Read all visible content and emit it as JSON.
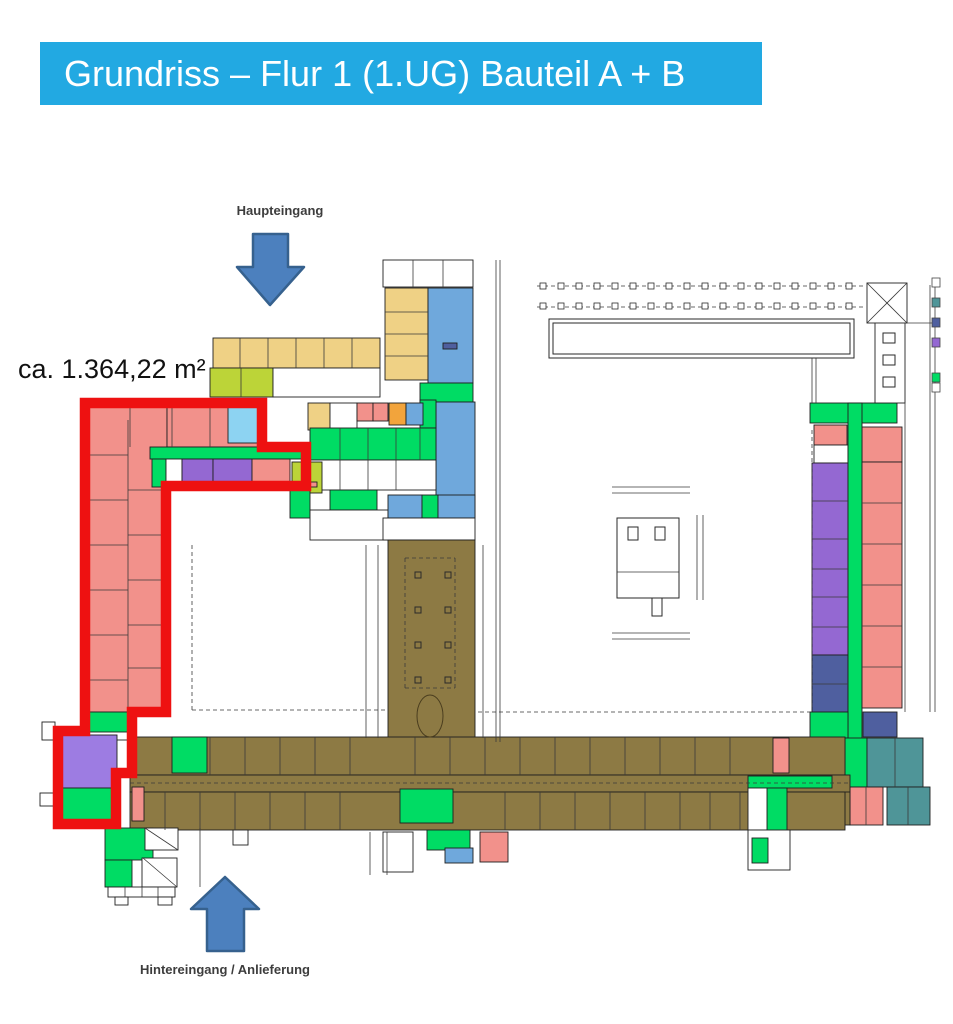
{
  "title": {
    "text": "Grundriss – Flur 1 (1.UG) Bauteil A + B"
  },
  "annotations": {
    "main_entrance": "Haupteingang",
    "area": "ca. 1.364,22 m²",
    "rear_entrance": "Hintereingang / Anlieferung"
  },
  "palette": {
    "header_bg": "#22A9E2",
    "red_outline": "#EE1111",
    "arrow_fill": "#4C80BE",
    "arrow_stroke": "#36618E",
    "sa": "#F2918B",
    "gr": "#00DC64",
    "bl": "#6FA8DC",
    "lb": "#8DD3F2",
    "wh": "#EFD185",
    "ch": "#BCD438",
    "or": "#F2A43C",
    "pu": "#9468D2",
    "pl": "#9D7CE2",
    "sl": "#4F5F9F",
    "te": "#4F9598",
    "br": "#8D7A44",
    "wt": "#FFFFFF"
  },
  "plan": {
    "outline_path": "M 85 403 L 262 403 L 262 447 L 306 447 L 306 486 L 166 486 L 166 712 L 132 712 L 132 773 L 116 773 L 116 824 L 58 824 L 58 731 L 85 731 Z",
    "rooms": [
      [
        383,
        260,
        90,
        27,
        "wt"
      ],
      [
        385,
        288,
        43,
        92,
        "wh"
      ],
      [
        428,
        288,
        45,
        95,
        "bl"
      ],
      [
        420,
        383,
        53,
        19,
        "gr"
      ],
      [
        436,
        402,
        39,
        116,
        "bl"
      ],
      [
        420,
        400,
        16,
        28,
        "gr"
      ],
      [
        213,
        338,
        167,
        30,
        "wh"
      ],
      [
        210,
        368,
        63,
        29,
        "ch"
      ],
      [
        273,
        368,
        107,
        29,
        "wt"
      ],
      [
        308,
        403,
        22,
        27,
        "wh"
      ],
      [
        330,
        403,
        27,
        27,
        "wt"
      ],
      [
        357,
        403,
        16,
        18,
        "sa"
      ],
      [
        373,
        403,
        15,
        18,
        "sa"
      ],
      [
        389,
        403,
        17,
        22,
        "or"
      ],
      [
        406,
        403,
        17,
        22,
        "bl"
      ],
      [
        310,
        428,
        126,
        32,
        "gr"
      ],
      [
        310,
        460,
        126,
        30,
        "wt"
      ],
      [
        292,
        462,
        30,
        31,
        "ch"
      ],
      [
        290,
        490,
        20,
        28,
        "gr"
      ],
      [
        330,
        490,
        47,
        20,
        "gr"
      ],
      [
        310,
        510,
        78,
        30,
        "wt"
      ],
      [
        388,
        495,
        34,
        23,
        "bl"
      ],
      [
        422,
        495,
        16,
        23,
        "gr"
      ],
      [
        438,
        495,
        37,
        23,
        "bl"
      ],
      [
        383,
        518,
        92,
        22,
        "wt"
      ],
      [
        85,
        400,
        82,
        312,
        "sa"
      ],
      [
        167,
        400,
        98,
        47,
        "sa"
      ],
      [
        228,
        405,
        37,
        38,
        "lb"
      ],
      [
        150,
        447,
        156,
        12,
        "gr"
      ],
      [
        152,
        459,
        14,
        28,
        "gr"
      ],
      [
        166,
        459,
        16,
        28,
        "wt"
      ],
      [
        182,
        459,
        31,
        28,
        "pu"
      ],
      [
        213,
        459,
        39,
        28,
        "pu"
      ],
      [
        252,
        459,
        38,
        28,
        "sa"
      ],
      [
        88,
        712,
        43,
        20,
        "gr"
      ],
      [
        116,
        740,
        16,
        33,
        "wt"
      ],
      [
        62,
        735,
        55,
        53,
        "pl"
      ],
      [
        62,
        788,
        55,
        36,
        "gr"
      ],
      [
        42,
        722,
        13,
        18,
        "wt"
      ],
      [
        40,
        793,
        16,
        13,
        "wt"
      ],
      [
        388,
        540,
        87,
        202,
        "br"
      ],
      [
        810,
        403,
        87,
        20,
        "gr"
      ],
      [
        814,
        425,
        33,
        20,
        "sa"
      ],
      [
        814,
        445,
        34,
        18,
        "wt"
      ],
      [
        862,
        427,
        40,
        35,
        "sa"
      ],
      [
        812,
        463,
        36,
        192,
        "pu"
      ],
      [
        812,
        655,
        36,
        57,
        "sl"
      ],
      [
        848,
        403,
        14,
        377,
        "gr"
      ],
      [
        862,
        462,
        40,
        246,
        "sa"
      ],
      [
        863,
        712,
        34,
        25,
        "sl"
      ],
      [
        810,
        712,
        38,
        26,
        "gr"
      ],
      [
        845,
        738,
        22,
        49,
        "gr"
      ],
      [
        867,
        738,
        56,
        49,
        "te"
      ],
      [
        887,
        787,
        43,
        38,
        "te"
      ],
      [
        850,
        787,
        33,
        38,
        "sa"
      ],
      [
        820,
        787,
        30,
        38,
        "br"
      ],
      [
        130,
        737,
        715,
        38,
        "br"
      ],
      [
        130,
        775,
        720,
        17,
        "br"
      ],
      [
        130,
        792,
        715,
        38,
        "br"
      ],
      [
        172,
        737,
        35,
        36,
        "gr"
      ],
      [
        773,
        738,
        16,
        35,
        "sa"
      ],
      [
        748,
        776,
        84,
        12,
        "gr"
      ],
      [
        767,
        788,
        20,
        79,
        "gr"
      ],
      [
        400,
        789,
        53,
        34,
        "gr"
      ],
      [
        132,
        787,
        12,
        34,
        "sa"
      ],
      [
        748,
        788,
        19,
        42,
        "wt"
      ],
      [
        427,
        830,
        43,
        20,
        "gr"
      ],
      [
        445,
        848,
        28,
        15,
        "bl"
      ],
      [
        480,
        832,
        28,
        30,
        "sa"
      ],
      [
        383,
        832,
        30,
        40,
        "wt"
      ],
      [
        748,
        830,
        42,
        40,
        "wt"
      ],
      [
        752,
        838,
        16,
        25,
        "gr"
      ],
      [
        105,
        828,
        48,
        32,
        "gr"
      ],
      [
        105,
        860,
        27,
        27,
        "gr"
      ],
      [
        145,
        828,
        33,
        22,
        "wt"
      ],
      [
        142,
        858,
        35,
        29,
        "wt"
      ],
      [
        108,
        887,
        67,
        10,
        "wt"
      ],
      [
        115,
        897,
        13,
        8,
        "wt"
      ],
      [
        158,
        897,
        14,
        8,
        "wt"
      ],
      [
        233,
        830,
        15,
        15,
        "wt"
      ],
      [
        867,
        283,
        40,
        40,
        "wt"
      ],
      [
        875,
        323,
        30,
        80,
        "wt"
      ],
      [
        443,
        343,
        14,
        6,
        "sl"
      ],
      [
        300,
        482,
        17,
        5,
        "sa"
      ]
    ],
    "boxes": [
      [
        549,
        319,
        305,
        39
      ],
      [
        553,
        323,
        297,
        31
      ],
      [
        883,
        333,
        12,
        10
      ],
      [
        883,
        355,
        12,
        10
      ],
      [
        883,
        377,
        12,
        10
      ],
      [
        617,
        518,
        62,
        80
      ],
      [
        628,
        527,
        10,
        13
      ],
      [
        655,
        527,
        10,
        13
      ],
      [
        652,
        598,
        10,
        18
      ],
      [
        415,
        572,
        6,
        6
      ],
      [
        445,
        572,
        6,
        6
      ],
      [
        415,
        607,
        6,
        6
      ],
      [
        445,
        607,
        6,
        6
      ],
      [
        415,
        642,
        6,
        6
      ],
      [
        445,
        642,
        6,
        6
      ],
      [
        415,
        677,
        6,
        6
      ],
      [
        445,
        677,
        6,
        6
      ]
    ],
    "walls": [
      [
        128,
        420,
        128,
        712
      ],
      [
        85,
        455,
        128,
        455
      ],
      [
        85,
        500,
        128,
        500
      ],
      [
        85,
        545,
        128,
        545
      ],
      [
        85,
        590,
        128,
        590
      ],
      [
        85,
        635,
        128,
        635
      ],
      [
        85,
        680,
        128,
        680
      ],
      [
        128,
        490,
        166,
        490
      ],
      [
        128,
        535,
        166,
        535
      ],
      [
        128,
        580,
        166,
        580
      ],
      [
        128,
        625,
        166,
        625
      ],
      [
        128,
        668,
        166,
        668
      ],
      [
        130,
        400,
        130,
        447
      ],
      [
        172,
        400,
        172,
        447
      ],
      [
        210,
        400,
        210,
        447
      ],
      [
        240,
        338,
        240,
        368
      ],
      [
        268,
        338,
        268,
        368
      ],
      [
        296,
        338,
        296,
        368
      ],
      [
        324,
        338,
        324,
        368
      ],
      [
        352,
        338,
        352,
        368
      ],
      [
        241,
        368,
        241,
        397
      ],
      [
        385,
        312,
        428,
        312
      ],
      [
        385,
        334,
        428,
        334
      ],
      [
        385,
        356,
        428,
        356
      ],
      [
        413,
        260,
        413,
        287
      ],
      [
        443,
        260,
        443,
        287
      ],
      [
        340,
        428,
        340,
        460
      ],
      [
        368,
        428,
        368,
        460
      ],
      [
        396,
        428,
        396,
        460
      ],
      [
        420,
        428,
        420,
        460
      ],
      [
        340,
        460,
        340,
        490
      ],
      [
        368,
        460,
        368,
        490
      ],
      [
        396,
        460,
        396,
        490
      ],
      [
        812,
        501,
        848,
        501
      ],
      [
        812,
        539,
        848,
        539
      ],
      [
        812,
        569,
        848,
        569
      ],
      [
        812,
        597,
        848,
        597
      ],
      [
        812,
        627,
        848,
        627
      ],
      [
        812,
        684,
        848,
        684
      ],
      [
        862,
        503,
        902,
        503
      ],
      [
        862,
        544,
        902,
        544
      ],
      [
        862,
        585,
        902,
        585
      ],
      [
        862,
        626,
        902,
        626
      ],
      [
        862,
        667,
        902,
        667
      ],
      [
        895,
        738,
        895,
        787
      ],
      [
        908,
        787,
        908,
        825
      ],
      [
        866,
        787,
        866,
        825
      ],
      [
        210,
        737,
        210,
        775
      ],
      [
        245,
        737,
        245,
        775
      ],
      [
        280,
        737,
        280,
        775
      ],
      [
        315,
        737,
        315,
        775
      ],
      [
        350,
        737,
        350,
        775
      ],
      [
        415,
        737,
        415,
        775
      ],
      [
        450,
        737,
        450,
        775
      ],
      [
        485,
        737,
        485,
        775
      ],
      [
        520,
        737,
        520,
        775
      ],
      [
        555,
        737,
        555,
        775
      ],
      [
        590,
        737,
        590,
        775
      ],
      [
        625,
        737,
        625,
        775
      ],
      [
        660,
        737,
        660,
        775
      ],
      [
        695,
        737,
        695,
        775
      ],
      [
        730,
        737,
        730,
        775
      ],
      [
        165,
        792,
        165,
        830
      ],
      [
        200,
        792,
        200,
        830
      ],
      [
        235,
        792,
        235,
        830
      ],
      [
        270,
        792,
        270,
        830
      ],
      [
        305,
        792,
        305,
        830
      ],
      [
        340,
        792,
        340,
        830
      ],
      [
        505,
        792,
        505,
        830
      ],
      [
        540,
        792,
        540,
        830
      ],
      [
        575,
        792,
        575,
        830
      ],
      [
        610,
        792,
        610,
        830
      ],
      [
        645,
        792,
        645,
        830
      ],
      [
        680,
        792,
        680,
        830
      ],
      [
        710,
        792,
        710,
        830
      ],
      [
        740,
        792,
        740,
        830
      ],
      [
        130,
        783,
        850,
        783,
        1
      ],
      [
        192,
        545,
        192,
        710,
        1
      ],
      [
        192,
        710,
        386,
        710,
        1
      ],
      [
        478,
        712,
        810,
        712,
        1
      ],
      [
        812,
        430,
        812,
        710,
        1
      ],
      [
        496,
        260,
        496,
        742
      ],
      [
        500,
        260,
        500,
        742
      ],
      [
        366,
        545,
        366,
        738
      ],
      [
        378,
        545,
        378,
        738
      ],
      [
        483,
        545,
        483,
        738
      ],
      [
        405,
        558,
        455,
        558,
        1
      ],
      [
        405,
        688,
        455,
        688,
        1
      ],
      [
        405,
        558,
        405,
        688,
        1
      ],
      [
        455,
        558,
        455,
        688,
        1
      ],
      [
        867,
        283,
        907,
        323
      ],
      [
        907,
        283,
        867,
        323
      ],
      [
        930,
        285,
        930,
        712
      ],
      [
        935,
        285,
        935,
        712
      ],
      [
        867,
        323,
        935,
        323
      ],
      [
        905,
        323,
        905,
        712
      ],
      [
        537,
        286,
        865,
        286,
        1
      ],
      [
        537,
        307,
        865,
        307,
        1
      ],
      [
        612,
        487,
        690,
        487
      ],
      [
        612,
        493,
        690,
        493
      ],
      [
        612,
        633,
        690,
        633
      ],
      [
        612,
        639,
        690,
        639
      ],
      [
        697,
        515,
        697,
        600
      ],
      [
        703,
        515,
        703,
        600
      ],
      [
        617,
        572,
        679,
        572
      ],
      [
        370,
        832,
        370,
        875
      ],
      [
        387,
        832,
        387,
        875
      ],
      [
        200,
        828,
        200,
        887
      ],
      [
        125,
        887,
        125,
        897
      ],
      [
        142,
        887,
        142,
        897
      ],
      [
        158,
        887,
        158,
        897
      ],
      [
        145,
        828,
        178,
        850
      ],
      [
        143,
        858,
        177,
        887
      ],
      [
        812,
        358,
        812,
        403
      ],
      [
        816,
        358,
        816,
        403
      ]
    ],
    "colonnade": {
      "x": 540,
      "rows": [
        283,
        303
      ],
      "n": 18,
      "step": 18,
      "size": 6
    },
    "legend_markers": [
      {
        "y": 278,
        "c": "wt"
      },
      {
        "y": 298,
        "c": "te"
      },
      {
        "y": 318,
        "c": "sl"
      },
      {
        "y": 338,
        "c": "pu"
      },
      {
        "y": 373,
        "c": "gr"
      },
      {
        "y": 383,
        "c": "wt"
      }
    ]
  }
}
